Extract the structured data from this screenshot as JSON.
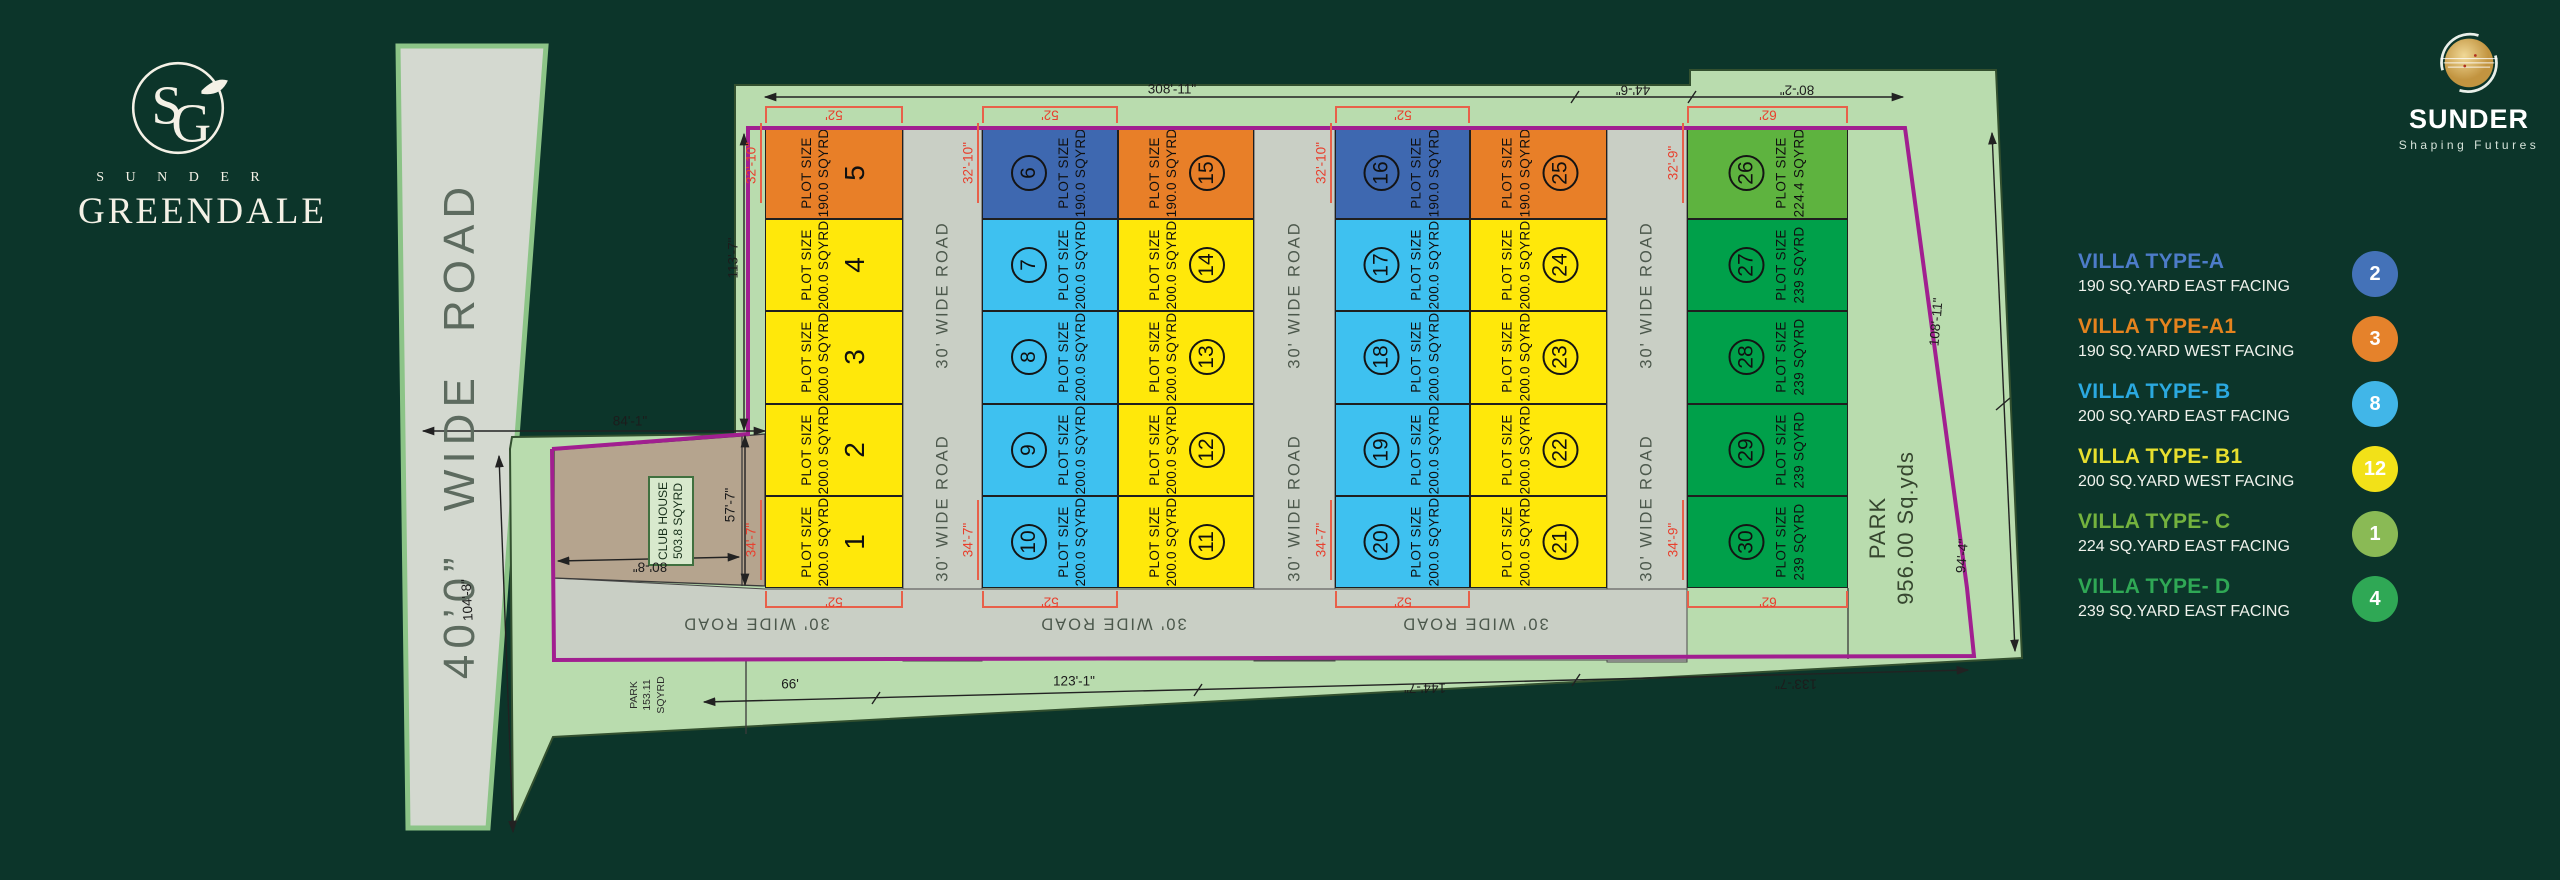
{
  "branding": {
    "left": {
      "monogram": "SG",
      "name": "S U N D E R",
      "title": "GREENDALE"
    },
    "right": {
      "name": "SUNDER",
      "tagline": "Shaping Futures"
    }
  },
  "legend": {
    "items": [
      {
        "title": "VILLA TYPE-A",
        "desc": "190 SQ.YARD EAST FACING",
        "count": "2",
        "title_color": "#4d7cc9",
        "badge_color": "#4472b8"
      },
      {
        "title": "VILLA TYPE-A1",
        "desc": "190 SQ.YARD WEST FACING",
        "count": "3",
        "title_color": "#e5831e",
        "badge_color": "#e5822b"
      },
      {
        "title": "VILLA TYPE- B",
        "desc": "200 SQ.YARD EAST FACING",
        "count": "8",
        "title_color": "#2ba9e0",
        "badge_color": "#41b6e8"
      },
      {
        "title": "VILLA TYPE- B1",
        "desc": "200 SQ.YARD WEST FACING",
        "count": "12",
        "title_color": "#e7df2e",
        "badge_color": "#f2e118"
      },
      {
        "title": "VILLA TYPE- C",
        "desc": "224 SQ.YARD EAST FACING",
        "count": "1",
        "title_color": "#74b23e",
        "badge_color": "#8aba55"
      },
      {
        "title": "VILLA TYPE- D",
        "desc": "239 SQ.YARD EAST FACING",
        "count": "4",
        "title_color": "#2fa855",
        "badge_color": "#2fa855"
      }
    ]
  },
  "plan": {
    "left_road_label": "40’0”  WIDE  ROAD",
    "road_label": "30' WIDE ROAD",
    "plot_label": "PLOT SIZE",
    "club_house": {
      "line1": "CLUB HOUSE",
      "line2": "503.8 SQYRD"
    },
    "park_main": {
      "line1": "PARK",
      "line2": "956.00 Sq.yds"
    },
    "park_small": {
      "line1": "PARK",
      "line2": "153.11",
      "line3": "SQYRD"
    },
    "type_colors": {
      "A": "#3e68b0",
      "A1": "#e87f28",
      "B": "#3ec1f0",
      "B1": "#ffe80a",
      "C": "#5eb33f",
      "D": "#00a04a"
    },
    "rows_top": 127,
    "rows_bottom": 588,
    "columns": [
      {
        "x": 765,
        "w": 138,
        "num_first": false,
        "circled": false,
        "plots": [
          {
            "n": "5",
            "size": "190.0 SQYRD",
            "type": "A1"
          },
          {
            "n": "4",
            "size": "200.0 SQYRD",
            "type": "B1"
          },
          {
            "n": "3",
            "size": "200.0 SQYRD",
            "type": "B1"
          },
          {
            "n": "2",
            "size": "200.0 SQYRD",
            "type": "B1"
          },
          {
            "n": "1",
            "size": "200.0 SQYRD",
            "type": "B1"
          }
        ]
      },
      {
        "x": 982,
        "w": 136,
        "num_first": true,
        "circled": true,
        "plots": [
          {
            "n": "6",
            "size": "190.0 SQYRD",
            "type": "A"
          },
          {
            "n": "7",
            "size": "200.0 SQYRD",
            "type": "B"
          },
          {
            "n": "8",
            "size": "200.0 SQYRD",
            "type": "B"
          },
          {
            "n": "9",
            "size": "200.0 SQYRD",
            "type": "B"
          },
          {
            "n": "10",
            "size": "200.0 SQYRD",
            "type": "B"
          }
        ]
      },
      {
        "x": 1118,
        "w": 136,
        "num_first": false,
        "circled": true,
        "plots": [
          {
            "n": "15",
            "size": "190.0 SQYRD",
            "type": "A1"
          },
          {
            "n": "14",
            "size": "200.0 SQYRD",
            "type": "B1"
          },
          {
            "n": "13",
            "size": "200.0 SQYRD",
            "type": "B1"
          },
          {
            "n": "12",
            "size": "200.0 SQYRD",
            "type": "B1"
          },
          {
            "n": "11",
            "size": "200.0 SQYRD",
            "type": "B1"
          }
        ]
      },
      {
        "x": 1335,
        "w": 135,
        "num_first": true,
        "circled": true,
        "plots": [
          {
            "n": "16",
            "size": "190.0 SQYRD",
            "type": "A"
          },
          {
            "n": "17",
            "size": "200.0 SQYRD",
            "type": "B"
          },
          {
            "n": "18",
            "size": "200.0 SQYRD",
            "type": "B"
          },
          {
            "n": "19",
            "size": "200.0 SQYRD",
            "type": "B"
          },
          {
            "n": "20",
            "size": "200.0 SQYRD",
            "type": "B"
          }
        ]
      },
      {
        "x": 1470,
        "w": 137,
        "num_first": false,
        "circled": true,
        "plots": [
          {
            "n": "25",
            "size": "190.0 SQYRD",
            "type": "A1"
          },
          {
            "n": "24",
            "size": "200.0 SQYRD",
            "type": "B1"
          },
          {
            "n": "23",
            "size": "200.0 SQYRD",
            "type": "B1"
          },
          {
            "n": "22",
            "size": "200.0 SQYRD",
            "type": "B1"
          },
          {
            "n": "21",
            "size": "200.0 SQYRD",
            "type": "B1"
          }
        ]
      },
      {
        "x": 1687,
        "w": 161,
        "num_first": true,
        "circled": true,
        "plots": [
          {
            "n": "26",
            "size": "224.4 SQYRD",
            "type": "C"
          },
          {
            "n": "27",
            "size": "239 SQYRD",
            "type": "D"
          },
          {
            "n": "28",
            "size": "239 SQYRD",
            "type": "D"
          },
          {
            "n": "29",
            "size": "239 SQYRD",
            "type": "D"
          },
          {
            "n": "30",
            "size": "239 SQYRD",
            "type": "D"
          }
        ]
      }
    ],
    "vroads": [
      {
        "x": 903,
        "w": 79
      },
      {
        "x": 1254,
        "w": 81
      },
      {
        "x": 1607,
        "w": 80
      }
    ],
    "vroad_label_y": [
      295,
      508
    ],
    "hroad_x": [
      756,
      1113,
      1475
    ],
    "hroad_y": 623,
    "brackets": [
      {
        "x": 765,
        "w": 138,
        "label": "52'"
      },
      {
        "x": 982,
        "w": 136,
        "label": "52'"
      },
      {
        "x": 1335,
        "w": 135,
        "label": "52'"
      },
      {
        "x": 1687,
        "w": 161,
        "label": "62'"
      }
    ],
    "dims": [
      {
        "t": "308'-11\"",
        "x": 1172,
        "y": 89,
        "r": 0
      },
      {
        "t": "44'-6\"",
        "x": 1633,
        "y": 90,
        "r": 180
      },
      {
        "t": "80'-2\"",
        "x": 1797,
        "y": 90,
        "r": 180
      },
      {
        "t": "113'-7\"",
        "x": 733,
        "y": 258,
        "r": -90
      },
      {
        "t": "84'-1\"",
        "x": 630,
        "y": 421,
        "r": 0
      },
      {
        "t": "104'-8\"",
        "x": 467,
        "y": 600,
        "r": -93
      },
      {
        "t": "57'-7\"",
        "x": 730,
        "y": 505,
        "r": -90
      },
      {
        "t": "80'-8\"",
        "x": 650,
        "y": 567,
        "r": 180
      },
      {
        "t": "66'",
        "x": 790,
        "y": 684,
        "r": 0
      },
      {
        "t": "123'-1\"",
        "x": 1074,
        "y": 681,
        "r": 0
      },
      {
        "t": "144'-7\"",
        "x": 1425,
        "y": 688,
        "r": 180
      },
      {
        "t": "133'-7\"",
        "x": 1796,
        "y": 684,
        "r": 180
      },
      {
        "t": "108'-11\"",
        "x": 1936,
        "y": 322,
        "r": -85
      },
      {
        "t": "94'-4\"",
        "x": 1962,
        "y": 556,
        "r": -85
      },
      {
        "t": "32'-10\"",
        "x": 751,
        "y": 163,
        "r": -90,
        "red": 1,
        "ln": 1
      },
      {
        "t": "32'-10\"",
        "x": 968,
        "y": 163,
        "r": -90,
        "red": 1,
        "ln": 1
      },
      {
        "t": "32'-10\"",
        "x": 1321,
        "y": 163,
        "r": -90,
        "red": 1,
        "ln": 1
      },
      {
        "t": "32'-9\"",
        "x": 1673,
        "y": 163,
        "r": -90,
        "red": 1,
        "ln": 1
      },
      {
        "t": "34'-7\"",
        "x": 751,
        "y": 540,
        "r": -90,
        "red": 1,
        "ln": 1
      },
      {
        "t": "34'-7\"",
        "x": 968,
        "y": 540,
        "r": -90,
        "red": 1,
        "ln": 1
      },
      {
        "t": "34'-7\"",
        "x": 1321,
        "y": 540,
        "r": -90,
        "red": 1,
        "ln": 1
      },
      {
        "t": "34'-9\"",
        "x": 1673,
        "y": 540,
        "r": -90,
        "red": 1,
        "ln": 1
      }
    ]
  }
}
